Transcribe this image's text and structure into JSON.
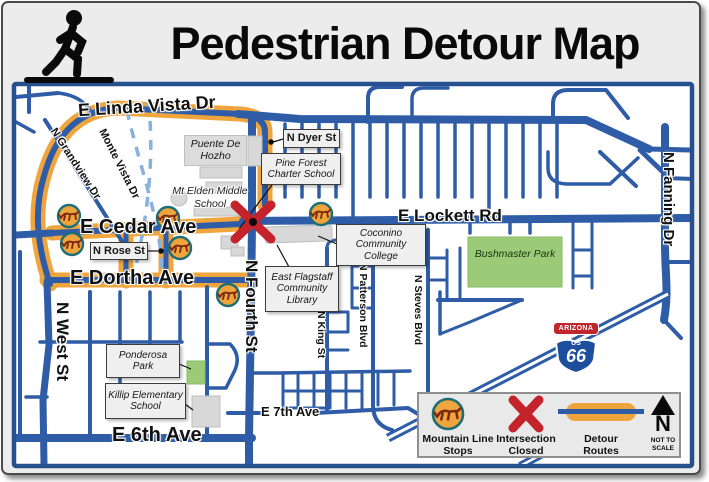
{
  "header": {
    "title": "Pedestrian Detour Map"
  },
  "map": {
    "streets": {
      "linda_vista": "E Linda Vista Dr",
      "dyer": "N Dyer St",
      "lockett": "E Lockett Rd",
      "cedar": "E Cedar Ave",
      "rose": "N Rose St",
      "dortha": "E Dortha Ave",
      "fourth": "N Fourth St",
      "west": "N West St",
      "fanning": "N Fanning Dr",
      "grandview": "N Grandview Dr",
      "monte_vista": "Monte Vista Dr",
      "king": "N King St",
      "patterson": "N Patterson Blvd",
      "steves": "N Steves Blvd",
      "sixth": "E 6th Ave",
      "seventh": "E 7th Ave"
    },
    "places": {
      "puente": "Puente De Hozho",
      "mt_elden": "Mt Elden Middle School",
      "pine_forest": "Pine Forest Charter School",
      "coconino": "Coconino Community College",
      "library": "East Flagstaff Community Library",
      "bushmaster": "Bushmaster Park",
      "ponderosa": "Ponderosa Park",
      "killip": "Killip Elementary School"
    },
    "route66": {
      "state": "ARIZONA",
      "us": "US",
      "number": "66"
    }
  },
  "legend": {
    "stops_label": "Mountain Line Stops",
    "closed_label": "Intersection Closed",
    "detour_label": "Detour Routes",
    "north_letter": "N",
    "scale_note": "NOT TO SCALE"
  },
  "colors": {
    "road_blue": "#2e5ca6",
    "detour_orange": "#f0a53c",
    "closed_red": "#c4232b",
    "park_green": "#9ccb78",
    "stop_ring_teal": "#1d6e79"
  }
}
